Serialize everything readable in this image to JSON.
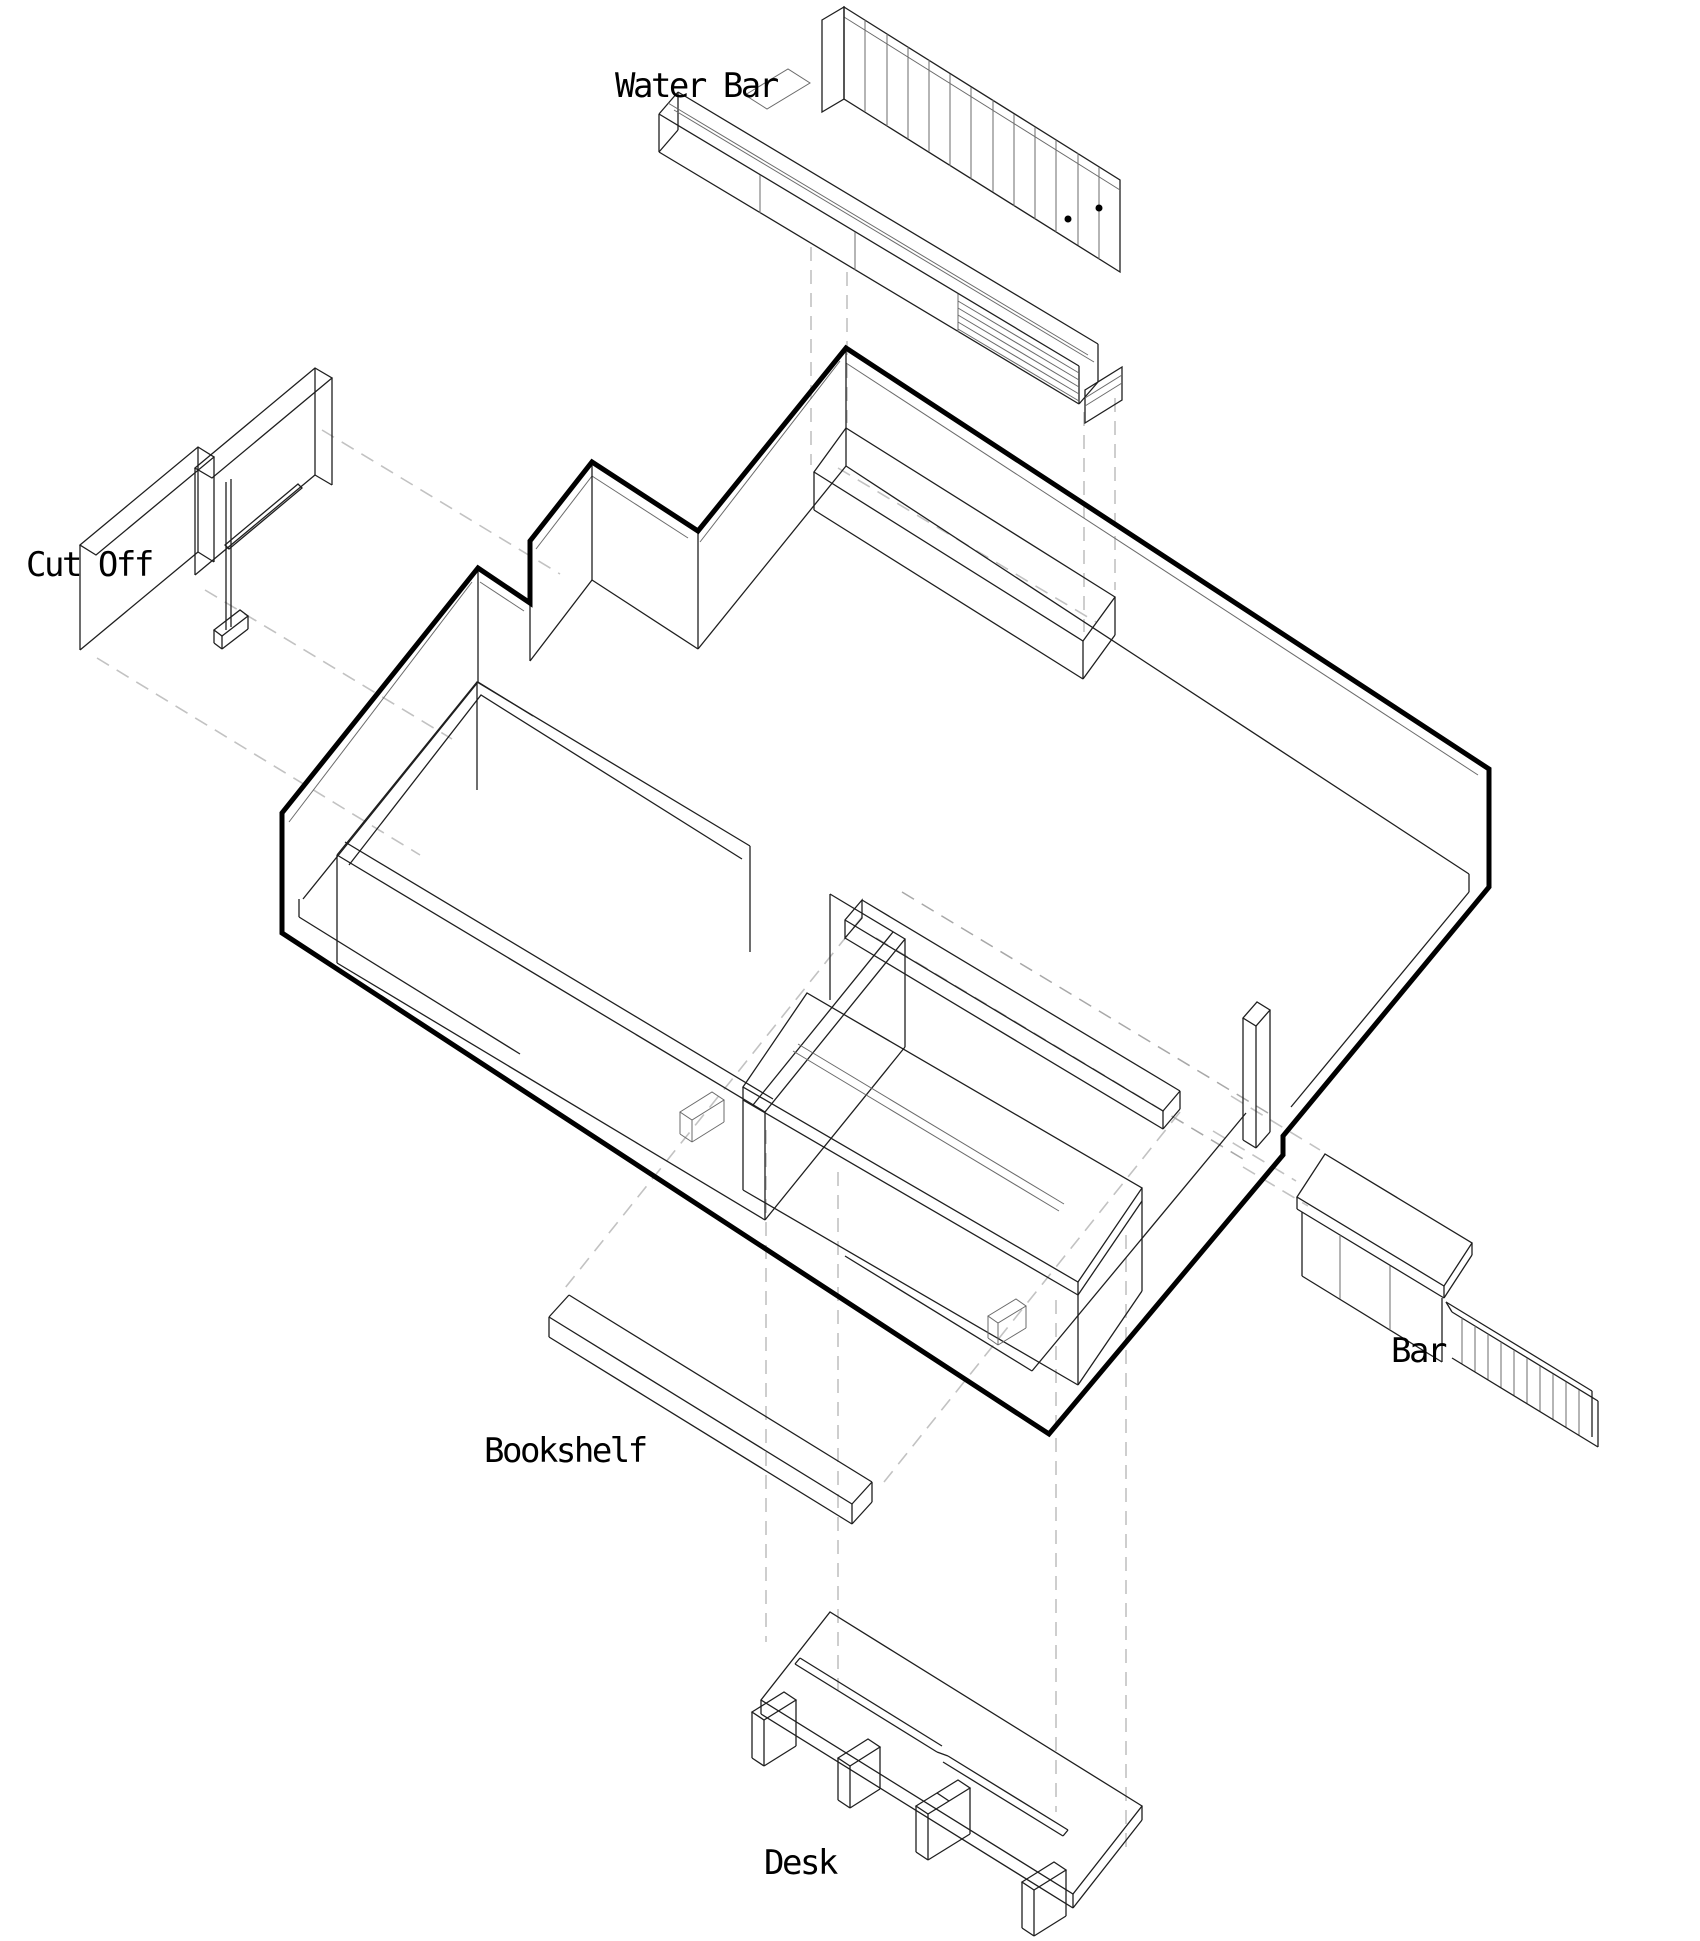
{
  "canvas": {
    "width": 1700,
    "height": 1941,
    "background": "#ffffff"
  },
  "diagram": {
    "type": "exploded-axonometric-floor-plan",
    "labels": {
      "water_bar": "Water Bar",
      "cut_off": "Cut Off",
      "bookshelf": "Bookshelf",
      "bar": "Bar",
      "desk": "Desk"
    },
    "components": [
      {
        "id": "water-bar",
        "label": "Water Bar",
        "position": "top"
      },
      {
        "id": "cut-off",
        "label": "Cut Off",
        "position": "left"
      },
      {
        "id": "bar",
        "label": "Bar",
        "position": "right"
      },
      {
        "id": "bookshelf",
        "label": "Bookshelf",
        "position": "bottom-left"
      },
      {
        "id": "desk",
        "label": "Desk",
        "position": "bottom"
      }
    ],
    "colors": {
      "outline": "#000000",
      "line": "#1f1f1f",
      "light_line": "#6b6b6b",
      "projection_dash": "#c2c2c2",
      "projection_dash_dark": "#a8a8a8",
      "label_text": "#000000"
    }
  }
}
